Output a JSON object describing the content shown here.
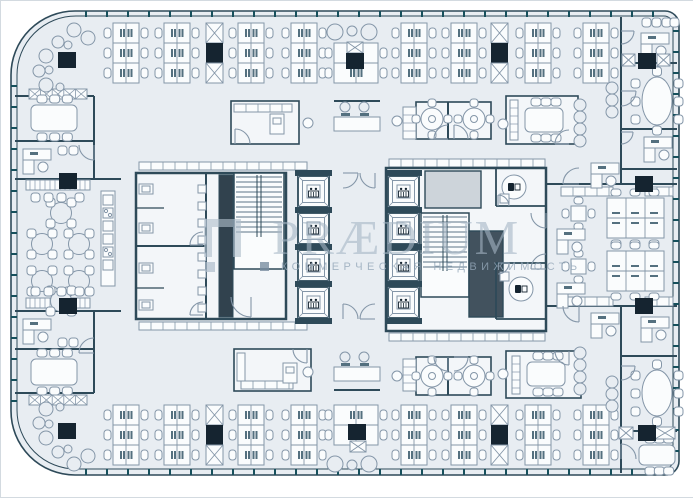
{
  "watermark": {
    "title": "PRÆDIUM",
    "subtitle": "КОММЕРЧЕСКАЯ НЕДВИЖИМОСТЬ"
  },
  "canvas": {
    "width": 693,
    "height": 496
  },
  "palette": {
    "outside": "#ffffff",
    "floor": "#e8edf2",
    "room": "#f3f6f9",
    "white": "#fafcfd",
    "wall": "#2e4a59",
    "line": "#8496a8",
    "dark": "#152430",
    "tick": "#17505c",
    "shaft_light": "#cdd4da",
    "shaft_dark": "#42525e",
    "band_dark": "#31424e",
    "monitor": "#54707f"
  },
  "plan": {
    "walls": [
      [
        14,
        95,
        93,
        95
      ],
      [
        14,
        140,
        93,
        140
      ],
      [
        93,
        95,
        93,
        178
      ],
      [
        14,
        178,
        120,
        178
      ],
      [
        14,
        310,
        120,
        310
      ],
      [
        93,
        310,
        93,
        392
      ],
      [
        14,
        348,
        93,
        348
      ],
      [
        14,
        392,
        93,
        392
      ],
      [
        620,
        16,
        620,
        183
      ],
      [
        620,
        305,
        620,
        472
      ],
      [
        620,
        62,
        676,
        62
      ],
      [
        620,
        128,
        676,
        128
      ],
      [
        620,
        168,
        676,
        168
      ],
      [
        620,
        355,
        676,
        355
      ],
      [
        620,
        430,
        676,
        430
      ],
      [
        545,
        183,
        676,
        183
      ],
      [
        545,
        305,
        676,
        305
      ],
      [
        447,
        101,
        447,
        138
      ],
      [
        447,
        356,
        447,
        394
      ],
      [
        333,
        100,
        379,
        100
      ],
      [
        333,
        389,
        379,
        389
      ]
    ],
    "room_rects": [
      [
        230,
        100,
        68,
        43
      ],
      [
        415,
        101,
        75,
        37
      ],
      [
        505,
        95,
        72,
        48
      ],
      [
        233,
        348,
        77,
        42
      ],
      [
        415,
        356,
        75,
        38
      ],
      [
        505,
        350,
        75,
        47
      ]
    ],
    "core_left": {
      "rect": [
        135,
        172,
        150,
        146
      ],
      "divider": [
        135,
        245,
        205,
        245
      ],
      "corridor": [
        205,
        172,
        205,
        318
      ],
      "stalls": [
        [
          135,
          207,
          163,
          207
        ],
        [
          135,
          287,
          163,
          287
        ]
      ],
      "shaft": [
        218,
        174,
        14,
        142
      ],
      "stair": [
        233,
        172,
        50,
        96
      ],
      "toilets": [
        [
          138,
          183
        ],
        [
          138,
          222
        ],
        [
          138,
          262
        ],
        [
          138,
          299
        ]
      ],
      "sinks_x": 197,
      "sinks_y": [
        184,
        201,
        218,
        235,
        252,
        269,
        286,
        303
      ]
    },
    "core_right": {
      "rect": [
        385,
        167,
        160,
        163
      ],
      "shaft_light": [
        424,
        170,
        56,
        37
      ],
      "shaft_dark": [
        468,
        230,
        34,
        86
      ],
      "stair": [
        420,
        212,
        48,
        84
      ],
      "wc_walls": [
        [
          495,
          167,
          495,
          205
        ],
        [
          495,
          205,
          545,
          205
        ],
        [
          495,
          262,
          545,
          262
        ],
        [
          495,
          262,
          495,
          318
        ],
        [
          495,
          318,
          545,
          318
        ]
      ],
      "wc": [
        [
          513,
          186
        ],
        [
          520,
          288
        ]
      ],
      "sinks": [
        [
          499,
          193
        ],
        [
          499,
          271
        ]
      ]
    },
    "elevators": {
      "size": 31,
      "banks": [
        {
          "x": 297,
          "ys": [
            175,
            212,
            249,
            286
          ]
        },
        {
          "x": 387,
          "ys": [
            175,
            212,
            249,
            286
          ]
        }
      ]
    },
    "clusters_h": {
      "w": 26,
      "row_h": 20,
      "top_y": 22,
      "bottom_y": 404,
      "rows": 3,
      "xs": [
        112,
        163,
        237,
        290,
        400,
        450,
        524,
        582
      ]
    },
    "clusters_special": [
      {
        "x": 333,
        "y": 42,
        "rows": 2,
        "w": 44
      },
      {
        "x": 333,
        "y": 404,
        "rows": 2,
        "w": 44
      }
    ],
    "clusters_v": [
      {
        "x": 606,
        "y": 197
      },
      {
        "x": 606,
        "y": 250
      }
    ],
    "columns": [
      [
        57,
        51
      ],
      [
        345,
        52
      ],
      [
        637,
        52
      ],
      [
        57,
        422
      ],
      [
        347,
        423
      ],
      [
        637,
        424
      ],
      [
        58,
        172
      ],
      [
        58,
        297
      ],
      [
        634,
        175
      ],
      [
        634,
        297
      ]
    ],
    "x_strips": [
      [
        205,
        22
      ],
      [
        490,
        22
      ],
      [
        205,
        404
      ],
      [
        490,
        404
      ]
    ],
    "x_cells": [
      [
        621,
        53,
        13,
        12
      ],
      [
        656,
        53,
        13,
        12
      ],
      [
        618,
        426,
        14,
        12
      ],
      [
        654,
        426,
        20,
        12
      ],
      [
        346,
        41,
        16,
        11
      ],
      [
        349,
        440,
        16,
        11
      ]
    ],
    "doors": [
      [
        342,
        172,
        15,
        "se"
      ],
      [
        374,
        172,
        15,
        "sw"
      ],
      [
        342,
        318,
        15,
        "ne"
      ],
      [
        374,
        318,
        15,
        "nw"
      ],
      [
        447,
        138,
        14,
        "nw"
      ],
      [
        453,
        138,
        14,
        "ne"
      ],
      [
        447,
        356,
        14,
        "sw"
      ],
      [
        453,
        356,
        14,
        "se"
      ],
      [
        568,
        143,
        14,
        "nw"
      ],
      [
        568,
        350,
        14,
        "sw"
      ],
      [
        234,
        143,
        15,
        "ne"
      ],
      [
        306,
        348,
        14,
        "sw"
      ],
      [
        202,
        244,
        13,
        "nw"
      ],
      [
        202,
        314,
        13,
        "nw"
      ],
      [
        250,
        296,
        20,
        "sw"
      ],
      [
        545,
        212,
        15,
        "sw"
      ],
      [
        545,
        268,
        15,
        "nw"
      ],
      [
        497,
        205,
        11,
        "ne"
      ],
      [
        497,
        262,
        11,
        "se"
      ],
      [
        620,
        30,
        13,
        "se"
      ],
      [
        620,
        90,
        15,
        "se"
      ],
      [
        620,
        131,
        12,
        "se"
      ],
      [
        620,
        365,
        14,
        "se"
      ],
      [
        620,
        458,
        15,
        "ne"
      ],
      [
        578,
        305,
        16,
        "sw"
      ],
      [
        578,
        183,
        16,
        "nw"
      ],
      [
        93,
        144,
        15,
        "sw"
      ],
      [
        93,
        352,
        15,
        "nw"
      ]
    ],
    "meeting_tables": [
      {
        "t": [
          30,
          104,
          46,
          26
        ],
        "top": 3,
        "bottom": 3
      },
      {
        "t": [
          30,
          358,
          46,
          26
        ],
        "top": 3,
        "bottom": 3
      },
      {
        "t": [
          524,
          107,
          38,
          24
        ],
        "top": 3,
        "bottom": 3
      },
      {
        "t": [
          526,
          361,
          38,
          24
        ],
        "top": 3,
        "bottom": 3
      },
      {
        "t": [
          638,
          444,
          36,
          20
        ],
        "top": 3,
        "bottom": 3
      }
    ],
    "cabinet_strips": [
      [
        509,
        99,
        8,
        40
      ],
      [
        511,
        355,
        8,
        38
      ],
      [
        402,
        106,
        13,
        32
      ],
      [
        402,
        358,
        13,
        32
      ]
    ],
    "oval_tables": [
      [
        656,
        100,
        15,
        24
      ],
      [
        656,
        392,
        15,
        23
      ]
    ],
    "round_tables": [
      [
        431,
        118
      ],
      [
        473,
        118
      ],
      [
        431,
        375
      ],
      [
        473,
        375
      ]
    ],
    "cafe_tables": [
      [
        60,
        212
      ],
      [
        41,
        243
      ],
      [
        78,
        243
      ],
      [
        41,
        280
      ],
      [
        78,
        280
      ],
      [
        60,
        300
      ]
    ],
    "small_tables": [
      [
        570,
        205
      ],
      [
        570,
        258
      ]
    ],
    "counters": [
      {
        "r": [
          25,
          179,
          64,
          10
        ],
        "s": "h"
      },
      {
        "r": [
          25,
          297,
          64,
          10
        ],
        "s": "h"
      },
      {
        "r": [
          28,
          88,
          58,
          10
        ],
        "s": "x"
      },
      {
        "r": [
          28,
          394,
          58,
          10
        ],
        "s": "x"
      },
      {
        "r": [
          138,
          161,
          168,
          8
        ],
        "s": "c"
      },
      {
        "r": [
          138,
          321,
          168,
          8
        ],
        "s": "c"
      },
      {
        "r": [
          388,
          158,
          156,
          8
        ],
        "s": "c"
      },
      {
        "r": [
          388,
          332,
          156,
          8
        ],
        "s": "c"
      },
      {
        "r": [
          233,
          103,
          58,
          8
        ],
        "s": "c"
      },
      {
        "r": [
          236,
          352,
          8,
          28
        ],
        "s": "c"
      },
      {
        "r": [
          240,
          380,
          52,
          8
        ],
        "s": "c"
      },
      {
        "r": [
          560,
          186,
          52,
          9
        ],
        "s": "c"
      },
      {
        "r": [
          644,
          186,
          28,
          9
        ],
        "s": "c"
      },
      {
        "r": [
          560,
          296,
          52,
          9
        ],
        "s": "c"
      },
      {
        "r": [
          644,
          296,
          28,
          9
        ],
        "s": "c"
      }
    ],
    "printers": [
      [
        269,
        113,
        14,
        20
      ],
      [
        282,
        362,
        14,
        20
      ]
    ],
    "kitchen": [
      100,
      190,
      14,
      95
    ],
    "benches": [
      [
        333,
        104
      ],
      [
        333,
        354
      ]
    ],
    "office_desks": [
      [
        22,
        148
      ],
      [
        22,
        318
      ],
      [
        640,
        32
      ],
      [
        643,
        136
      ],
      [
        590,
        162
      ],
      [
        590,
        312
      ],
      [
        640,
        316
      ],
      [
        556,
        228
      ],
      [
        556,
        282
      ]
    ],
    "seats": [
      [
        30,
        192
      ],
      [
        43,
        192
      ],
      [
        56,
        192
      ],
      [
        74,
        192
      ],
      [
        30,
        286
      ],
      [
        43,
        286
      ],
      [
        56,
        286
      ],
      [
        74,
        286
      ],
      [
        641,
        17
      ],
      [
        651,
        17
      ],
      [
        661,
        17
      ],
      [
        669,
        17
      ],
      [
        57,
        145
      ],
      [
        68,
        145
      ],
      [
        57,
        337
      ],
      [
        68,
        337
      ]
    ],
    "lounge_circles": [
      [
        73,
        29,
        7
      ],
      [
        87,
        37,
        7
      ],
      [
        57,
        41,
        6
      ],
      [
        45,
        55,
        7
      ],
      [
        38,
        70,
        6
      ],
      [
        45,
        84,
        7
      ],
      [
        67,
        44,
        4
      ],
      [
        48,
        69,
        4
      ],
      [
        59,
        86,
        4
      ],
      [
        73,
        463,
        7
      ],
      [
        87,
        455,
        7
      ],
      [
        57,
        451,
        6
      ],
      [
        45,
        437,
        7
      ],
      [
        38,
        422,
        6
      ],
      [
        45,
        408,
        7
      ],
      [
        67,
        448,
        4
      ],
      [
        48,
        423,
        4
      ],
      [
        59,
        406,
        4
      ],
      [
        334,
        31,
        8
      ],
      [
        351,
        30,
        5
      ],
      [
        368,
        31,
        8
      ],
      [
        334,
        463,
        8
      ],
      [
        351,
        464,
        5
      ],
      [
        368,
        463,
        8
      ],
      [
        579,
        104,
        6
      ],
      [
        579,
        116,
        6
      ],
      [
        579,
        128,
        6
      ],
      [
        579,
        140,
        6
      ],
      [
        611,
        87,
        6
      ],
      [
        611,
        99,
        6
      ],
      [
        611,
        111,
        6
      ],
      [
        579,
        352,
        6
      ],
      [
        579,
        364,
        6
      ],
      [
        579,
        376,
        6
      ],
      [
        579,
        388,
        6
      ],
      [
        611,
        381,
        6
      ],
      [
        611,
        393,
        6
      ],
      [
        611,
        405,
        6
      ]
    ],
    "single_chairs": [
      [
        307,
        122
      ],
      [
        396,
        120
      ],
      [
        307,
        371
      ],
      [
        396,
        375
      ],
      [
        502,
        123
      ],
      [
        502,
        373
      ]
    ],
    "ticks": {
      "step": 21,
      "top": [
        85,
        655,
        10
      ],
      "bottom": [
        85,
        655,
        468
      ],
      "left": [
        85,
        400,
        10
      ],
      "right": [
        30,
        455,
        672
      ]
    }
  }
}
